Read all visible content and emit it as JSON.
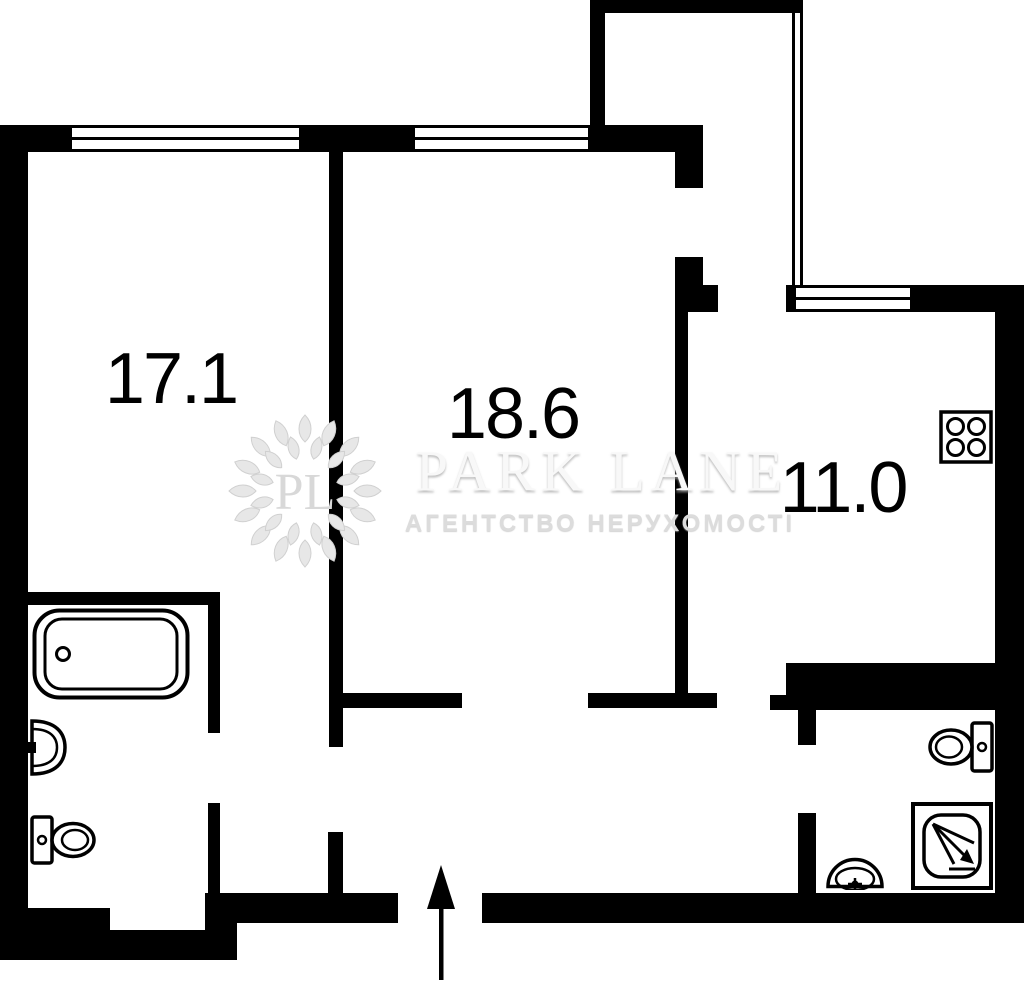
{
  "plan": {
    "rooms": [
      {
        "id": "bedroom",
        "area_label": "17.1"
      },
      {
        "id": "living-room",
        "area_label": "18.6"
      },
      {
        "id": "kitchen",
        "area_label": "11.0"
      }
    ],
    "fixtures": [
      "bathtub",
      "sink",
      "toilet",
      "stove",
      "toilet",
      "shower",
      "sink"
    ],
    "entrance": "arrow-up"
  },
  "watermark": {
    "monogram": "PL",
    "brand": "PARK LANE",
    "tagline": "АГЕНТСТВО НЕРУХОМОСТІ"
  },
  "colors": {
    "wall": "#000000",
    "background": "#ffffff",
    "watermark_gray": "#e7e7e7"
  }
}
